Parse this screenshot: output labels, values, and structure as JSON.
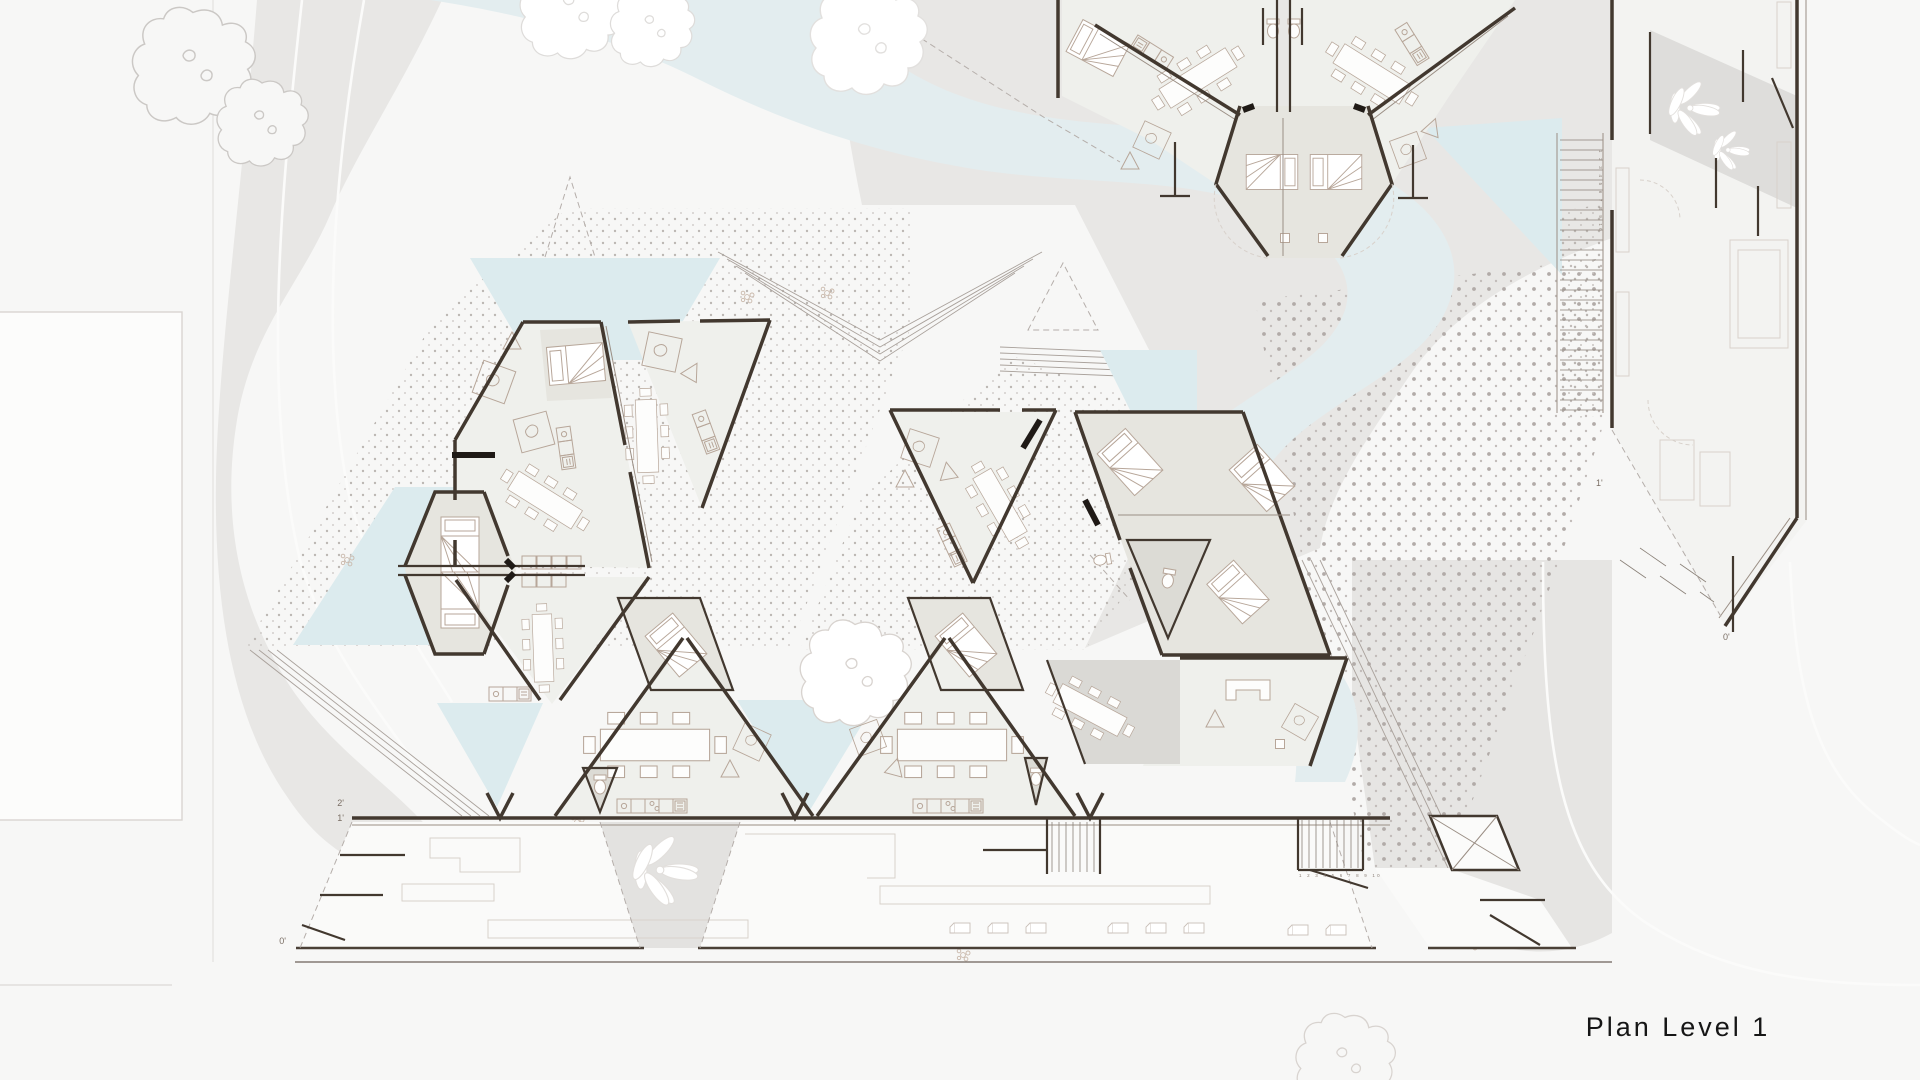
{
  "drawing": {
    "caption": "Plan Level 1",
    "levels": {
      "zero": "0'",
      "one": "1'",
      "two": "2'"
    },
    "stair_treads_label": "1 2 3 4 5 6 7 8 9 10",
    "colors": {
      "background": "#f7f7f6",
      "terrain_gray": "#e8e7e5",
      "river_blue": "#e3edef",
      "pond_triangle_blue": "#d9e9ec",
      "wall_dark": "#42382f",
      "furniture_line": "#b7a699",
      "bedroom_floor": "#e6e5df",
      "room_floor": "#eff0ec",
      "bath_floor": "#dcdbd5",
      "patio_gray": "#dad9d5",
      "paving_dot": "#b8b2af",
      "caption_text": "#161616",
      "level_marker_text": "#7a6e64"
    }
  }
}
